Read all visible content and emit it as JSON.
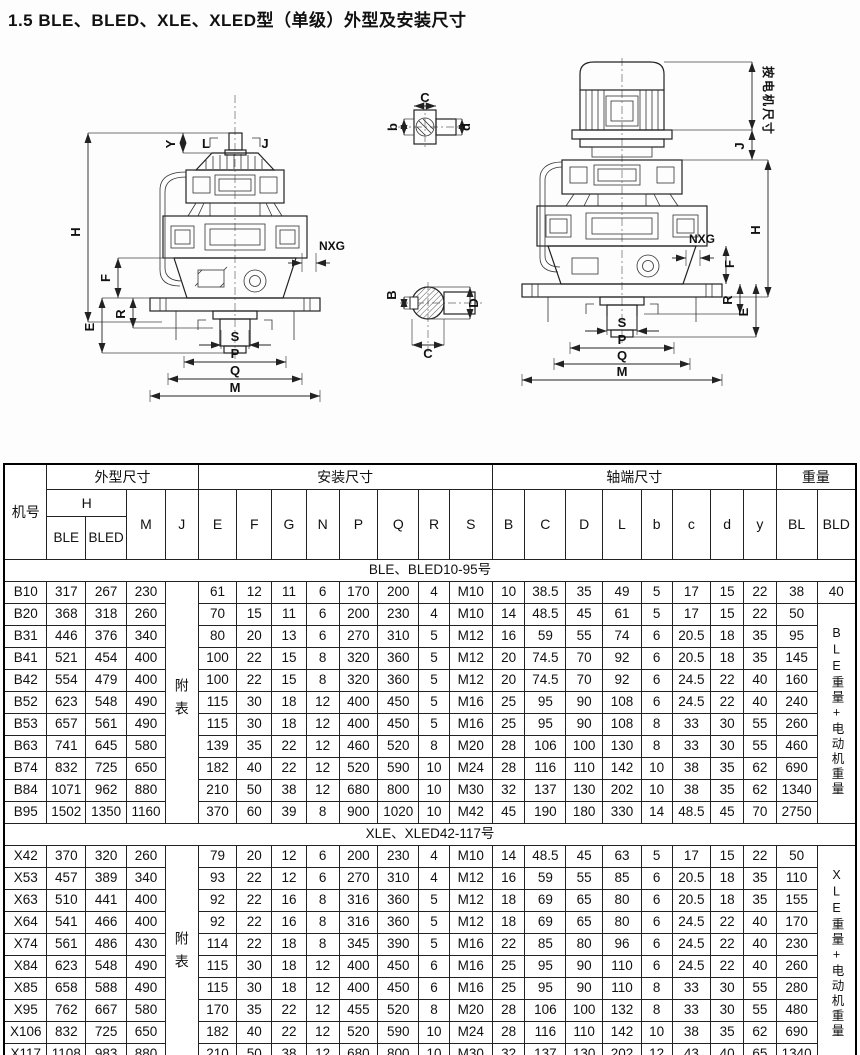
{
  "page": {
    "title": "1.5 BLE、BLED、XLE、XLED型（单级）外型及安装尺寸"
  },
  "drawings": {
    "left": {
      "y": "Y",
      "l": "L",
      "j": "J",
      "h": "H",
      "f": "F",
      "r": "R",
      "e": "E",
      "nxg": "NXG",
      "s": "S",
      "p": "P",
      "q": "Q",
      "m": "M"
    },
    "key_detail": {
      "c": "C",
      "b": "b",
      "d": "d"
    },
    "shaft_section": {
      "b": "B",
      "d": "D",
      "c": "C"
    },
    "right": {
      "motor_dim": "按电机尺寸",
      "j": "J",
      "h": "H",
      "nxg": "NXG",
      "f": "F",
      "r": "R",
      "e": "E",
      "s": "S",
      "p": "P",
      "q": "Q",
      "m": "M"
    }
  },
  "table": {
    "header": {
      "jihao": "机号",
      "group_outline": "外型尺寸",
      "group_install": "安装尺寸",
      "group_shaft": "轴端尺寸",
      "group_weight": "重量",
      "h": "H",
      "ble": "BLE",
      "bled": "BLED",
      "m": "M",
      "j": "J",
      "cols_install": [
        "E",
        "F",
        "G",
        "N",
        "P",
        "Q",
        "R",
        "S"
      ],
      "cols_shaft": [
        "B",
        "C",
        "D",
        "L",
        "b",
        "c",
        "d",
        "y"
      ],
      "bl": "BL",
      "bld": "BLD"
    },
    "sections": [
      {
        "title": "BLE、BLED10-95号",
        "appendix_label": "附表",
        "weight_note": "BLE重量+电动机重量",
        "first_row_bld": "40",
        "rows": [
          [
            "B10",
            "317",
            "267",
            "230",
            "61",
            "12",
            "11",
            "6",
            "170",
            "200",
            "4",
            "M10",
            "10",
            "38.5",
            "35",
            "49",
            "5",
            "17",
            "15",
            "22",
            "38"
          ],
          [
            "B20",
            "368",
            "318",
            "260",
            "70",
            "15",
            "11",
            "6",
            "200",
            "230",
            "4",
            "M10",
            "14",
            "48.5",
            "45",
            "61",
            "5",
            "17",
            "15",
            "22",
            "50"
          ],
          [
            "B31",
            "446",
            "376",
            "340",
            "80",
            "20",
            "13",
            "6",
            "270",
            "310",
            "5",
            "M12",
            "16",
            "59",
            "55",
            "74",
            "6",
            "20.5",
            "18",
            "35",
            "95"
          ],
          [
            "B41",
            "521",
            "454",
            "400",
            "100",
            "22",
            "15",
            "8",
            "320",
            "360",
            "5",
            "M12",
            "20",
            "74.5",
            "70",
            "92",
            "6",
            "20.5",
            "18",
            "35",
            "145"
          ],
          [
            "B42",
            "554",
            "479",
            "400",
            "100",
            "22",
            "15",
            "8",
            "320",
            "360",
            "5",
            "M12",
            "20",
            "74.5",
            "70",
            "92",
            "6",
            "24.5",
            "22",
            "40",
            "160"
          ],
          [
            "B52",
            "623",
            "548",
            "490",
            "115",
            "30",
            "18",
            "12",
            "400",
            "450",
            "5",
            "M16",
            "25",
            "95",
            "90",
            "108",
            "6",
            "24.5",
            "22",
            "40",
            "240"
          ],
          [
            "B53",
            "657",
            "561",
            "490",
            "115",
            "30",
            "18",
            "12",
            "400",
            "450",
            "5",
            "M16",
            "25",
            "95",
            "90",
            "108",
            "8",
            "33",
            "30",
            "55",
            "260"
          ],
          [
            "B63",
            "741",
            "645",
            "580",
            "139",
            "35",
            "22",
            "12",
            "460",
            "520",
            "8",
            "M20",
            "28",
            "106",
            "100",
            "130",
            "8",
            "33",
            "30",
            "55",
            "460"
          ],
          [
            "B74",
            "832",
            "725",
            "650",
            "182",
            "40",
            "22",
            "12",
            "520",
            "590",
            "10",
            "M24",
            "28",
            "116",
            "110",
            "142",
            "10",
            "38",
            "35",
            "62",
            "690"
          ],
          [
            "B84",
            "1071",
            "962",
            "880",
            "210",
            "50",
            "38",
            "12",
            "680",
            "800",
            "10",
            "M30",
            "32",
            "137",
            "130",
            "202",
            "10",
            "38",
            "35",
            "62",
            "1340"
          ],
          [
            "B95",
            "1502",
            "1350",
            "1160",
            "370",
            "60",
            "39",
            "8",
            "900",
            "1020",
            "10",
            "M42",
            "45",
            "190",
            "180",
            "330",
            "14",
            "48.5",
            "45",
            "70",
            "2750"
          ]
        ]
      },
      {
        "title": "XLE、XLED42-117号",
        "appendix_label": "附表",
        "weight_note": "XLE重量+电动机重量",
        "first_row_bld": null,
        "rows": [
          [
            "X42",
            "370",
            "320",
            "260",
            "79",
            "20",
            "12",
            "6",
            "200",
            "230",
            "4",
            "M10",
            "14",
            "48.5",
            "45",
            "63",
            "5",
            "17",
            "15",
            "22",
            "50"
          ],
          [
            "X53",
            "457",
            "389",
            "340",
            "93",
            "22",
            "12",
            "6",
            "270",
            "310",
            "4",
            "M12",
            "16",
            "59",
            "55",
            "85",
            "6",
            "20.5",
            "18",
            "35",
            "110"
          ],
          [
            "X63",
            "510",
            "441",
            "400",
            "92",
            "22",
            "16",
            "8",
            "316",
            "360",
            "5",
            "M12",
            "18",
            "69",
            "65",
            "80",
            "6",
            "20.5",
            "18",
            "35",
            "155"
          ],
          [
            "X64",
            "541",
            "466",
            "400",
            "92",
            "22",
            "16",
            "8",
            "316",
            "360",
            "5",
            "M12",
            "18",
            "69",
            "65",
            "80",
            "6",
            "24.5",
            "22",
            "40",
            "170"
          ],
          [
            "X74",
            "561",
            "486",
            "430",
            "114",
            "22",
            "18",
            "8",
            "345",
            "390",
            "5",
            "M16",
            "22",
            "85",
            "80",
            "96",
            "6",
            "24.5",
            "22",
            "40",
            "230"
          ],
          [
            "X84",
            "623",
            "548",
            "490",
            "115",
            "30",
            "18",
            "12",
            "400",
            "450",
            "6",
            "M16",
            "25",
            "95",
            "90",
            "110",
            "6",
            "24.5",
            "22",
            "40",
            "260"
          ],
          [
            "X85",
            "658",
            "588",
            "490",
            "115",
            "30",
            "18",
            "12",
            "400",
            "450",
            "6",
            "M16",
            "25",
            "95",
            "90",
            "110",
            "8",
            "33",
            "30",
            "55",
            "280"
          ],
          [
            "X95",
            "762",
            "667",
            "580",
            "170",
            "35",
            "22",
            "12",
            "455",
            "520",
            "8",
            "M20",
            "28",
            "106",
            "100",
            "132",
            "8",
            "33",
            "30",
            "55",
            "480"
          ],
          [
            "X106",
            "832",
            "725",
            "650",
            "182",
            "40",
            "22",
            "12",
            "520",
            "590",
            "10",
            "M24",
            "28",
            "116",
            "110",
            "142",
            "10",
            "38",
            "35",
            "62",
            "690"
          ],
          [
            "X117",
            "1108",
            "983",
            "880",
            "210",
            "50",
            "38",
            "12",
            "680",
            "800",
            "10",
            "M30",
            "32",
            "137",
            "130",
            "202",
            "12",
            "43",
            "40",
            "65",
            "1340"
          ]
        ]
      }
    ]
  }
}
